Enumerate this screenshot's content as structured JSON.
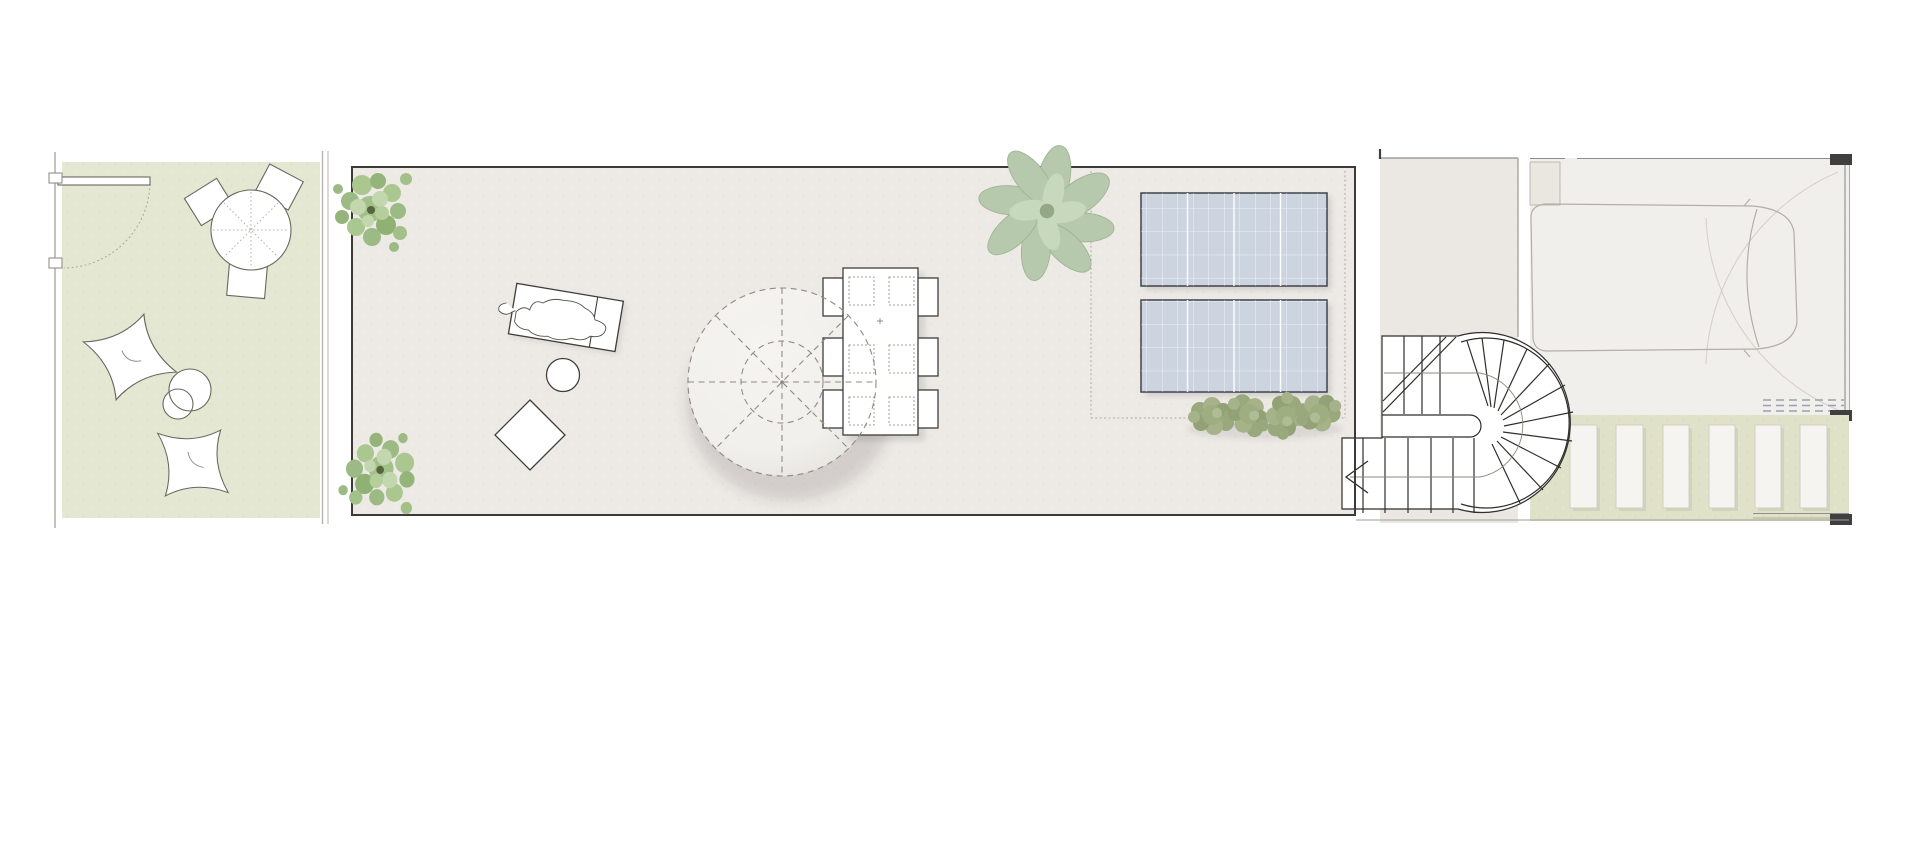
{
  "meta": {
    "drawing_type": "architectural roof-terrace / courtyard floor plan, top view",
    "visible_text": "",
    "canvas_size": "1920x850"
  },
  "colors": {
    "canvas_bg": "#ffffff",
    "patio_lawn_green": "#e4e7d1",
    "terrace_floor": "#edeae6",
    "stair_zone_floor": "#ebe8e3",
    "garage_floor": "#f1efec",
    "driveway_green": "#dfe2c8",
    "umbrella_canvas": "#f4f3ef",
    "solar_panel_blue": "#ccd4e0",
    "solar_panel_frame": "#3e434b",
    "foliage_green": "#9cba83",
    "foliage_light": "#c3d7ae",
    "foliage_dark": "#55663f",
    "hedge_olive": "#9aa87d",
    "agave_sage": "#b7c9ac",
    "ink_dark": "#3c3a36",
    "ink_light": "#a29d94",
    "wall_black": "#3f3f3f"
  },
  "plan": {
    "left_patio": {
      "surface": "lawn green",
      "door_with_swing_arc": 1,
      "wall_ticks": 2,
      "bistro_table": {
        "shape": "round",
        "chairs": 3
      },
      "bean_bag_cushions": 2,
      "round_poufs": 2
    },
    "main_terrace": {
      "surface": "light stone",
      "corner_shrubs": 2,
      "sun_lounger": 1,
      "round_side_table": 1,
      "diamond_floor_cushion": 1,
      "parasol": {
        "shape": "circle",
        "ribs": 8,
        "outline": "dashed"
      },
      "dining_table": {
        "chairs": 6,
        "placemats": 6
      }
    },
    "equipment_zone": {
      "boundary": "dotted rectangle",
      "solar_panels": 2,
      "hedge_shrubs": 4,
      "accent_plant": 1
    },
    "staircase": {
      "type": "half-turn stair with curved winder end",
      "straight_flights": 2,
      "radial_winder_treads": 11,
      "direction_arrow": true,
      "central_handrail_slot": true
    },
    "garage": {
      "car": 1,
      "gate_swing_arcs": 2,
      "drain_grate_dash_rows": 3,
      "wall_piers": 3
    },
    "driveway": {
      "paver_slabs": 6,
      "surface": "lawn green"
    }
  }
}
